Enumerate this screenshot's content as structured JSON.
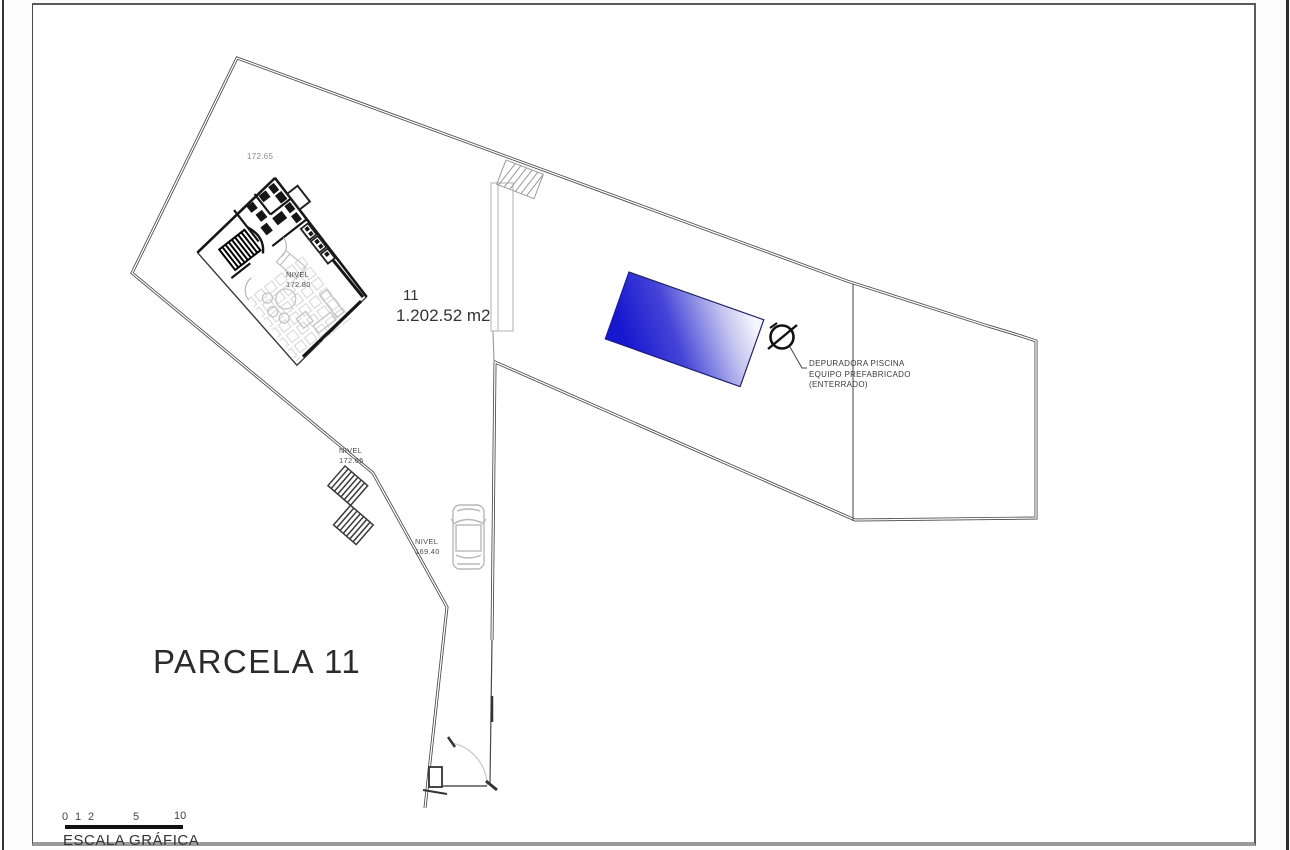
{
  "drawing": {
    "title": "PARCELA 11",
    "plot_number": "11",
    "plot_area": "1.202.52 m2",
    "levels": {
      "top": "172.65",
      "house": {
        "label": "NIVEL",
        "value": "172.80"
      },
      "stairs": {
        "label": "NIVEL",
        "value": "172.65"
      },
      "driveway": {
        "label": "NIVEL",
        "value": "169.40"
      }
    },
    "pool_note": {
      "line1": "DEPURADORA PISCINA",
      "line2": "EQUIPO PREFABRICADO",
      "line3": "(ENTERRADO)"
    },
    "scale_bar": {
      "numbers": [
        "0",
        "1",
        "2",
        "5",
        "10"
      ],
      "caption": "ESCALA GRÁFICA"
    },
    "colors": {
      "pool_dark": "#1717cf",
      "pool_mid": "#4545d8",
      "pool_fade": "#c3c3f0",
      "pool_light": "#f6f6fe",
      "line": "#4a4a4a"
    }
  }
}
